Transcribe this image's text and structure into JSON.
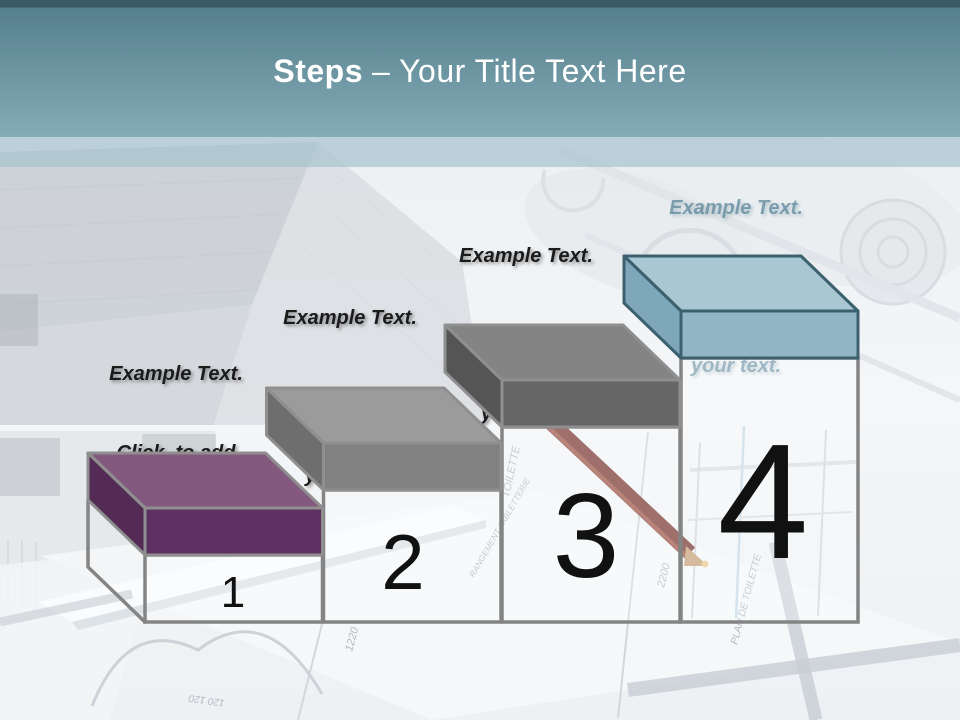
{
  "header": {
    "title_bold": "Steps",
    "title_rest": "– Your Title Text Here",
    "text_color": "#ffffff",
    "accent_top": "#3a5a66",
    "accent_mid": "#567f8d",
    "accent_bottom": "#83acb7",
    "divider_band": "#a7c4cf"
  },
  "steps": {
    "pedestal_stroke": "#848484",
    "number_color": "#111111",
    "items": [
      {
        "number": "1",
        "caption_lines": [
          "Example Text.",
          "Click  to add",
          "your text."
        ],
        "caption_color": "#1b1b1b",
        "colors": {
          "top": "#84597f",
          "side": "#532b54",
          "front": "#5e3162",
          "stroke": "#8f8f8f"
        }
      },
      {
        "number": "2",
        "caption_lines": [
          "Example Text.",
          "Click  to add",
          "your text."
        ],
        "caption_color": "#1b1b1b",
        "colors": {
          "top": "#9b9b9b",
          "side": "#6e6e6e",
          "front": "#818181",
          "stroke": "#8f8f8f"
        }
      },
      {
        "number": "3",
        "caption_lines": [
          "Example Text.",
          "Click  to add",
          "your text."
        ],
        "caption_color": "#1b1b1b",
        "colors": {
          "top": "#848484",
          "side": "#555555",
          "front": "#666666",
          "stroke": "#8f8f8f"
        }
      },
      {
        "number": "4",
        "caption_lines": [
          "Example Text.",
          "Click  to add",
          "your text."
        ],
        "caption_color": "rgba(63,114,136,0.60)",
        "colors": {
          "top": "#a9c7d3",
          "side": "#7ea8ba",
          "front": "#92b5c5",
          "stroke": "#3c616e"
        }
      }
    ]
  },
  "background": {
    "plan_labels": [
      "TOILETTE",
      "RANGEMENT TABLETTERIE",
      "PLAN DE TOILETTE",
      "1220",
      "2200",
      "120 120"
    ]
  }
}
